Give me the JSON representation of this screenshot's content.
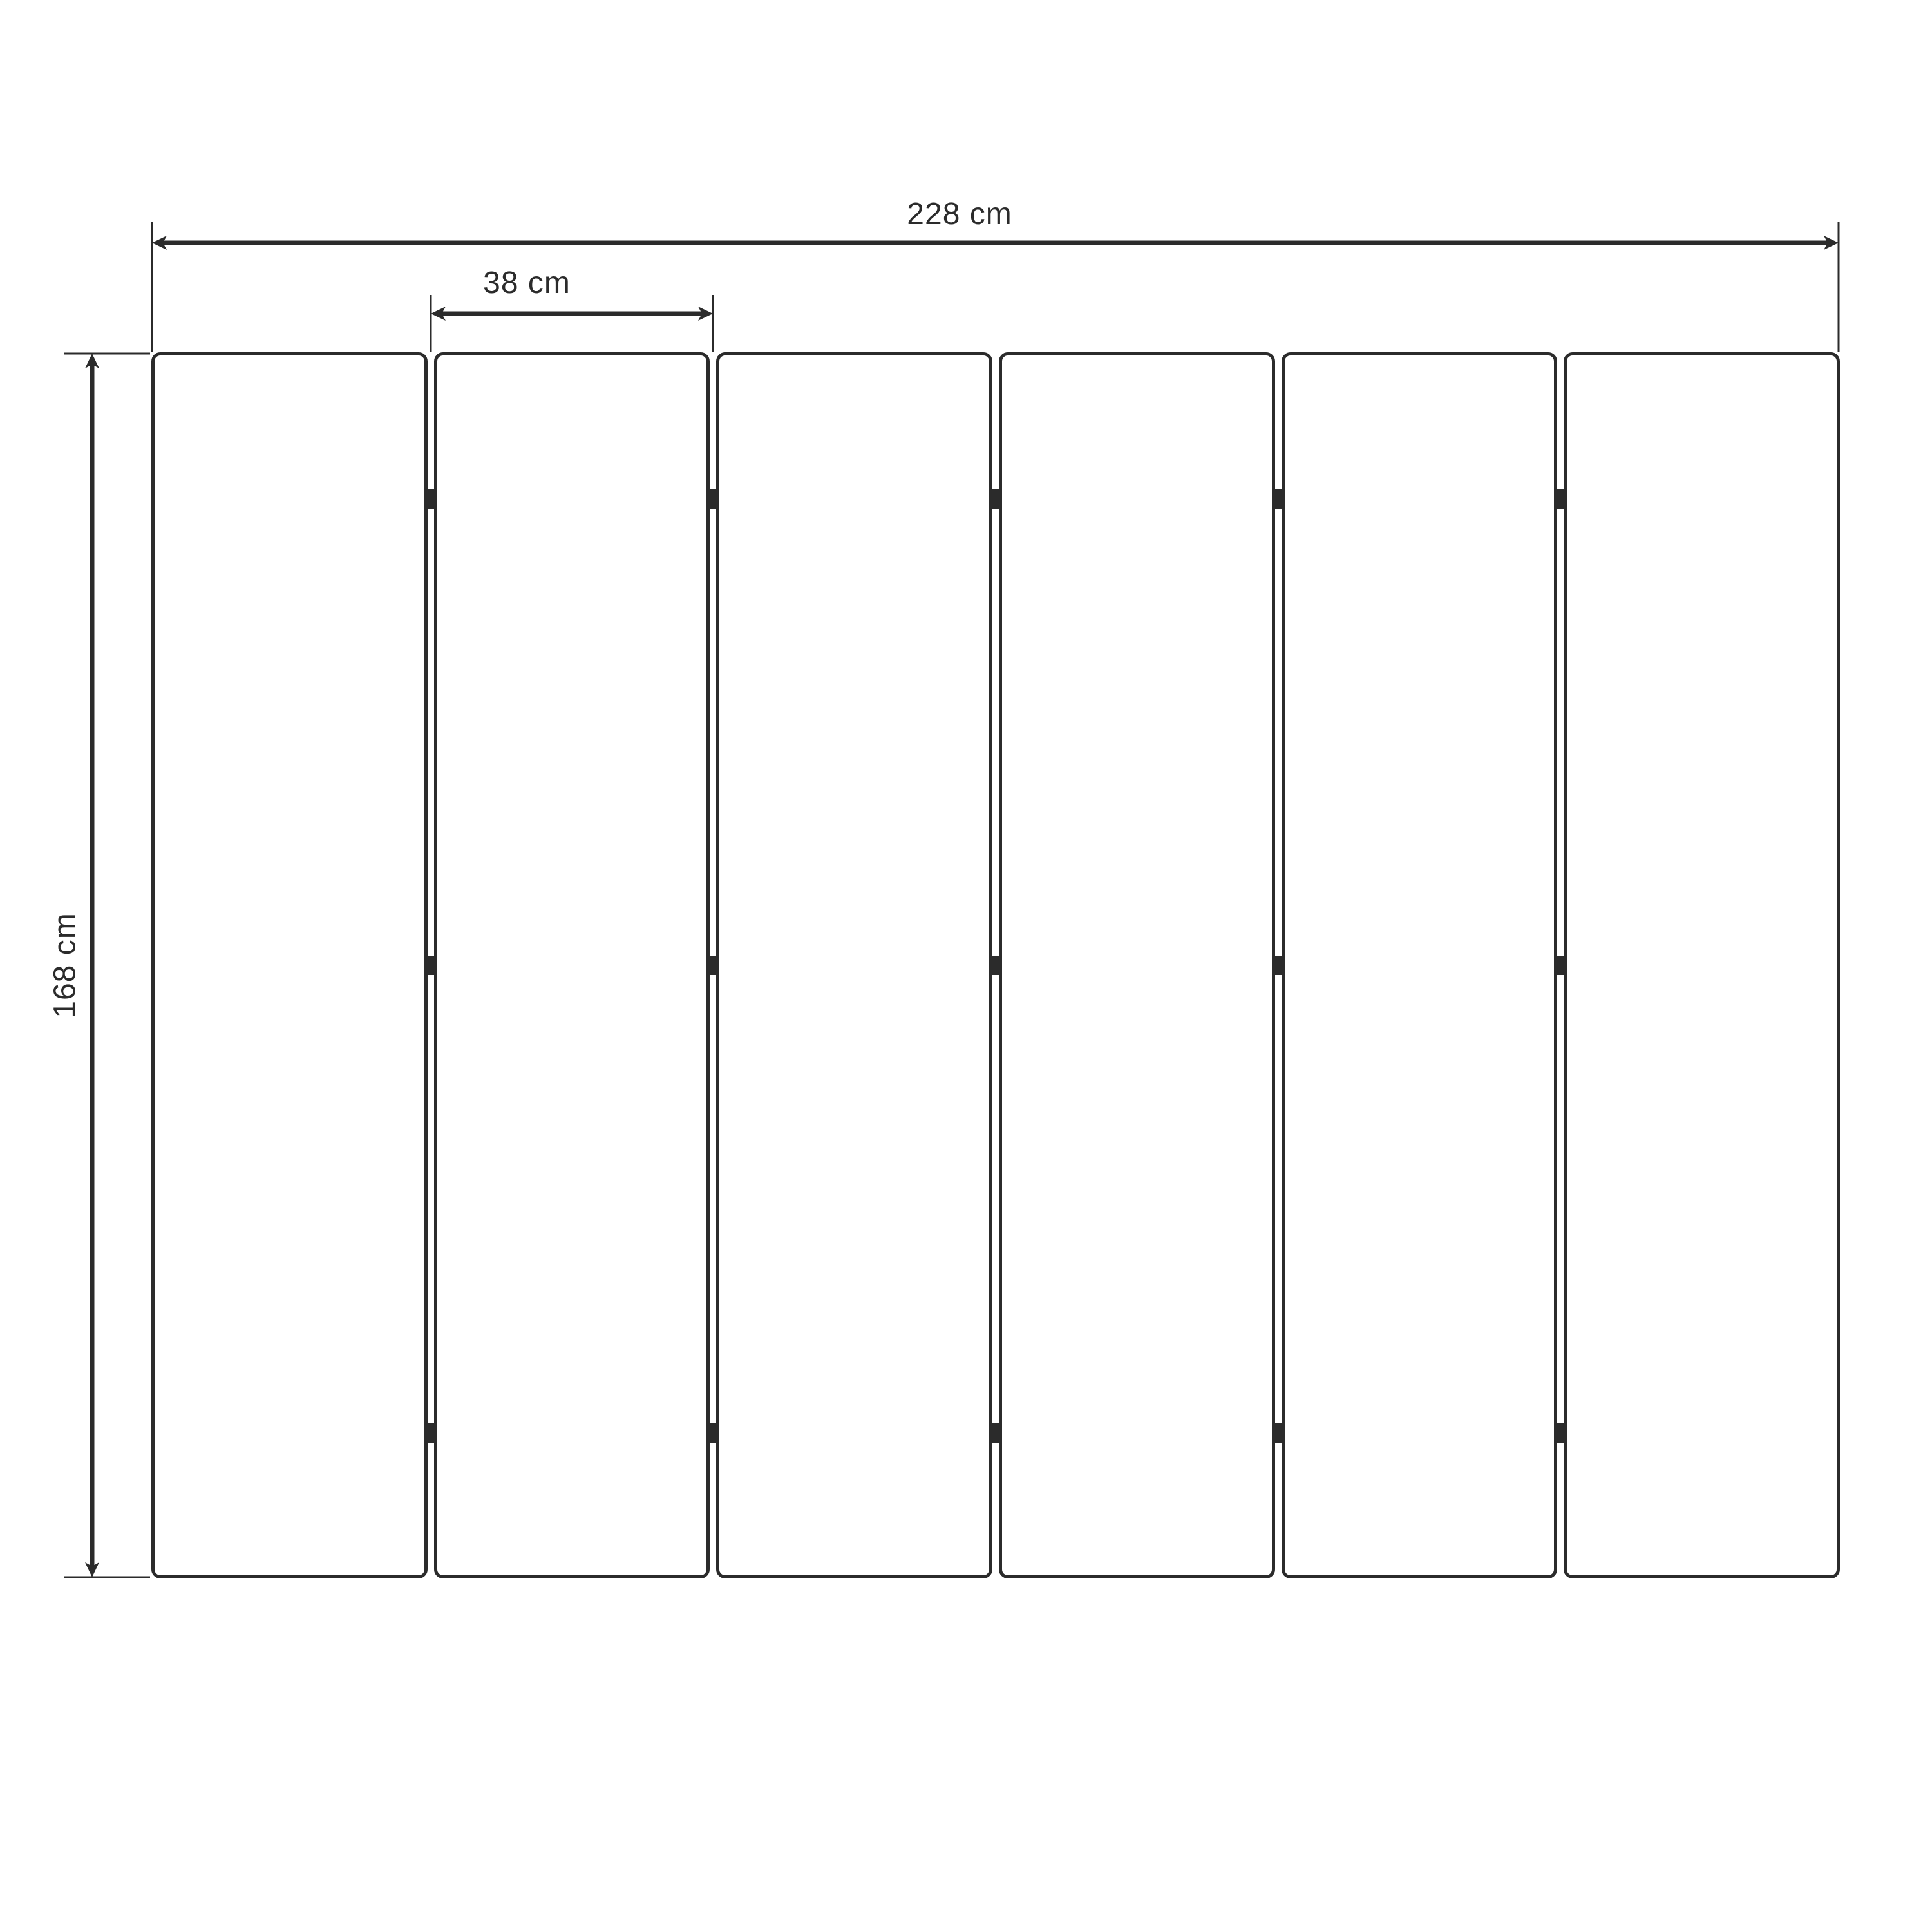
{
  "diagram": {
    "kind": "folding-screen panel dimension drawing",
    "panel_count": 6,
    "hinge_rows_per_gap": 3,
    "labels": {
      "total_width": "228 cm",
      "panel_width": "38 cm",
      "height": "168 cm"
    },
    "colors": {
      "line": "#2b2b2b",
      "background": "#ffffff"
    }
  }
}
